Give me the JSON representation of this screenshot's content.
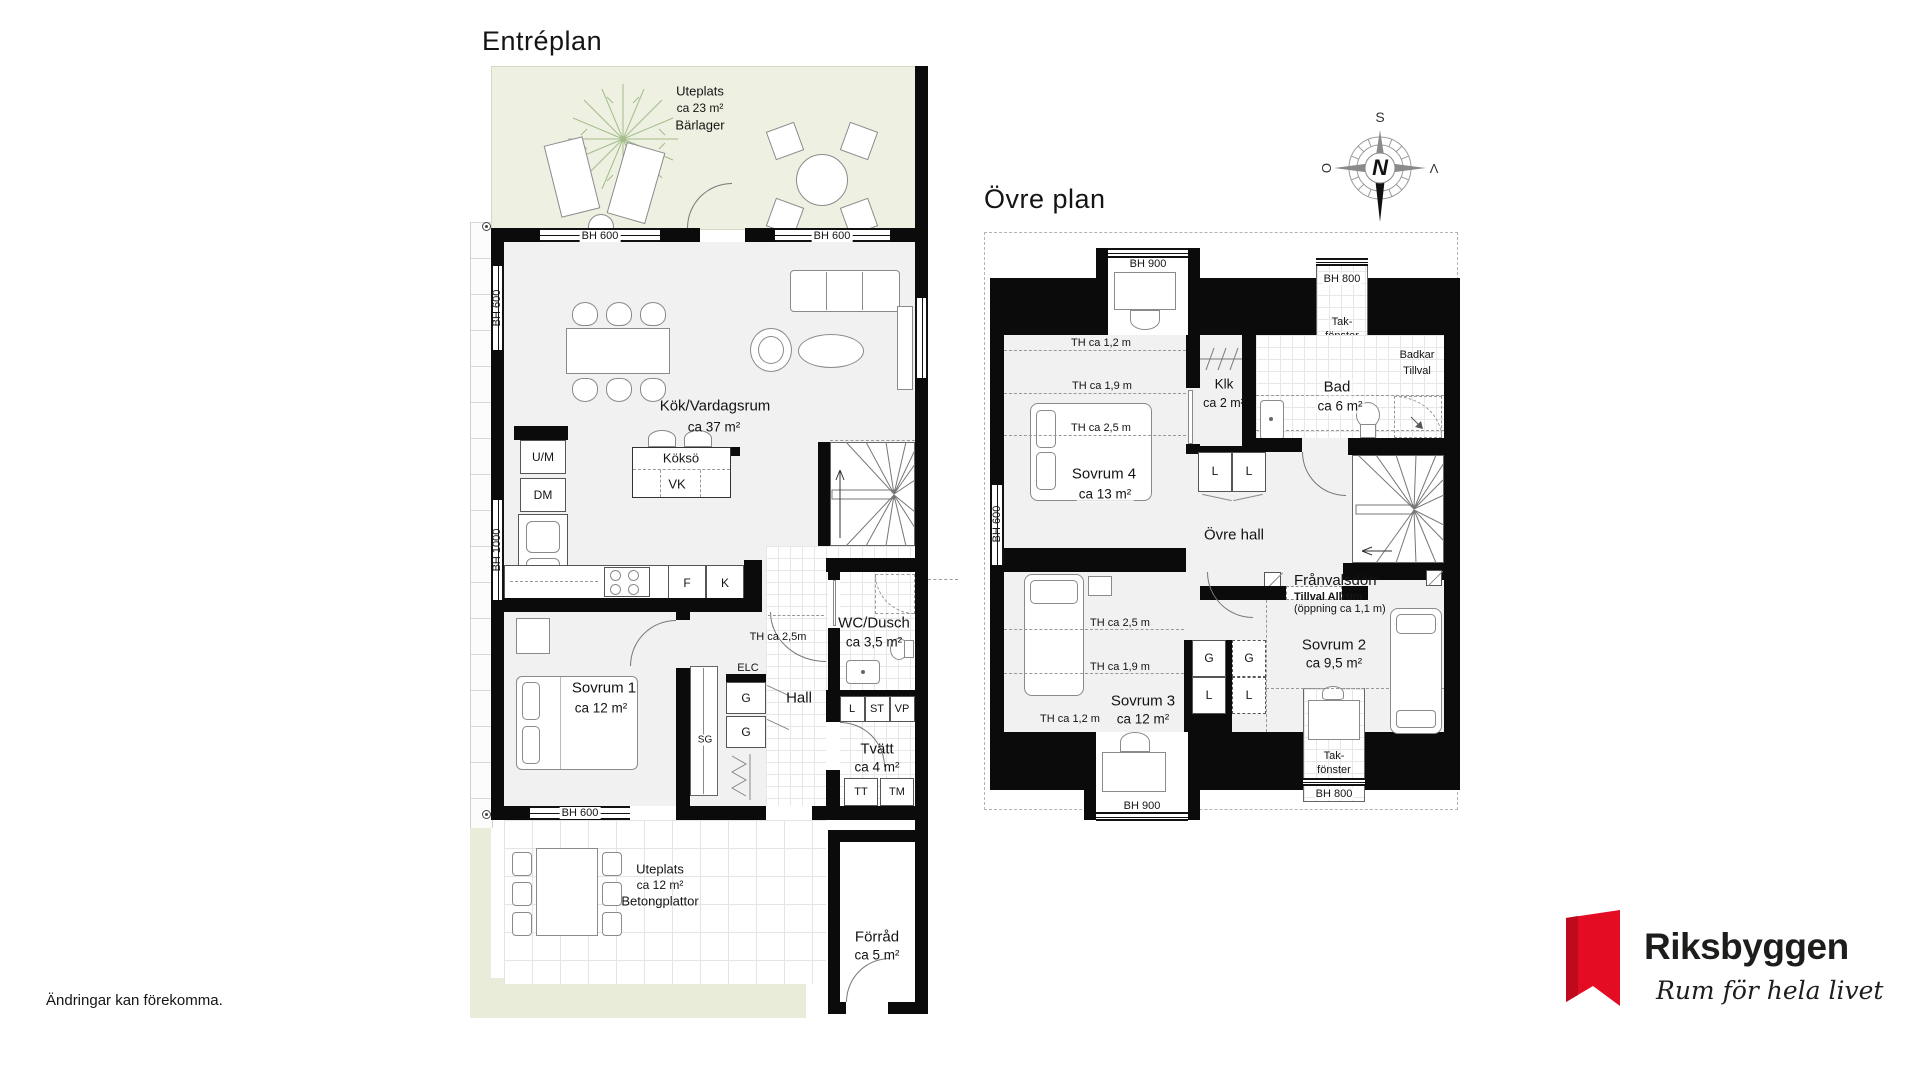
{
  "disclaimer": "Ändringar kan förekomma.",
  "brand": {
    "name": "Riksbyggen",
    "tagline": "Rum för hela livet",
    "logo_color": "#e30c23"
  },
  "compass": {
    "n": "N",
    "s": "S",
    "o": "O",
    "v": "V"
  },
  "f1": {
    "title": "Entréplan",
    "terrace_top": {
      "name": "Uteplats",
      "area": "ca 23 m²",
      "surface": "Bärlager"
    },
    "terrace_bottom": {
      "name": "Uteplats",
      "area": "ca 12 m²",
      "surface": "Betongplattor"
    },
    "kitchen": {
      "name": "Kök/Vardagsrum",
      "area": "ca 37 m²"
    },
    "island": {
      "name": "Köksö",
      "mark": "VK"
    },
    "bedroom1": {
      "name": "Sovrum 1",
      "area": "ca 12 m²"
    },
    "wc": {
      "name": "WC/Dusch",
      "area": "ca 3,5 m²"
    },
    "hall": {
      "name": "Hall"
    },
    "laundry": {
      "name": "Tvätt",
      "area": "ca 4 m²"
    },
    "storage": {
      "name": "Förråd",
      "area": "ca 5 m²"
    },
    "units": {
      "um": "U/M",
      "dm": "DM",
      "f": "F",
      "k": "K",
      "elc": "ELC",
      "g": "G",
      "sg": "SG",
      "l": "L",
      "st": "ST",
      "vp": "VP",
      "tt": "TT",
      "tm": "TM"
    },
    "marks": {
      "th25": "TH ca 2,5m",
      "bh600": "BH 600",
      "bh1000": "BH 1000"
    }
  },
  "f2": {
    "title": "Övre plan",
    "bedroom4": {
      "name": "Sovrum 4",
      "area": "ca 13 m²"
    },
    "closet": {
      "name": "Klk",
      "area": "ca 2 m²"
    },
    "bath": {
      "name": "Bad",
      "area": "ca 6 m²"
    },
    "bath_option": {
      "line1": "Badkar",
      "line2": "Tillval"
    },
    "hall": {
      "name": "Övre hall"
    },
    "bedroom2": {
      "name": "Sovrum 2",
      "area": "ca 9,5 m²"
    },
    "bedroom3": {
      "name": "Sovrum 3",
      "area": "ca 12 m²"
    },
    "skylight": {
      "line1": "Tak-",
      "line2": "fönster"
    },
    "door_option": {
      "line1": "Frånvalsdörr",
      "line2": "Tillval Allrum",
      "line3": "(öppning ca 1,1 m)"
    },
    "units": {
      "g": "G",
      "l": "L"
    },
    "marks": {
      "th12": "TH ca 1,2 m",
      "th19": "TH ca 1,9 m",
      "th25": "TH ca 2,5 m",
      "bh600": "BH 600",
      "bh800": "BH 800",
      "bh900": "BH 900"
    }
  }
}
